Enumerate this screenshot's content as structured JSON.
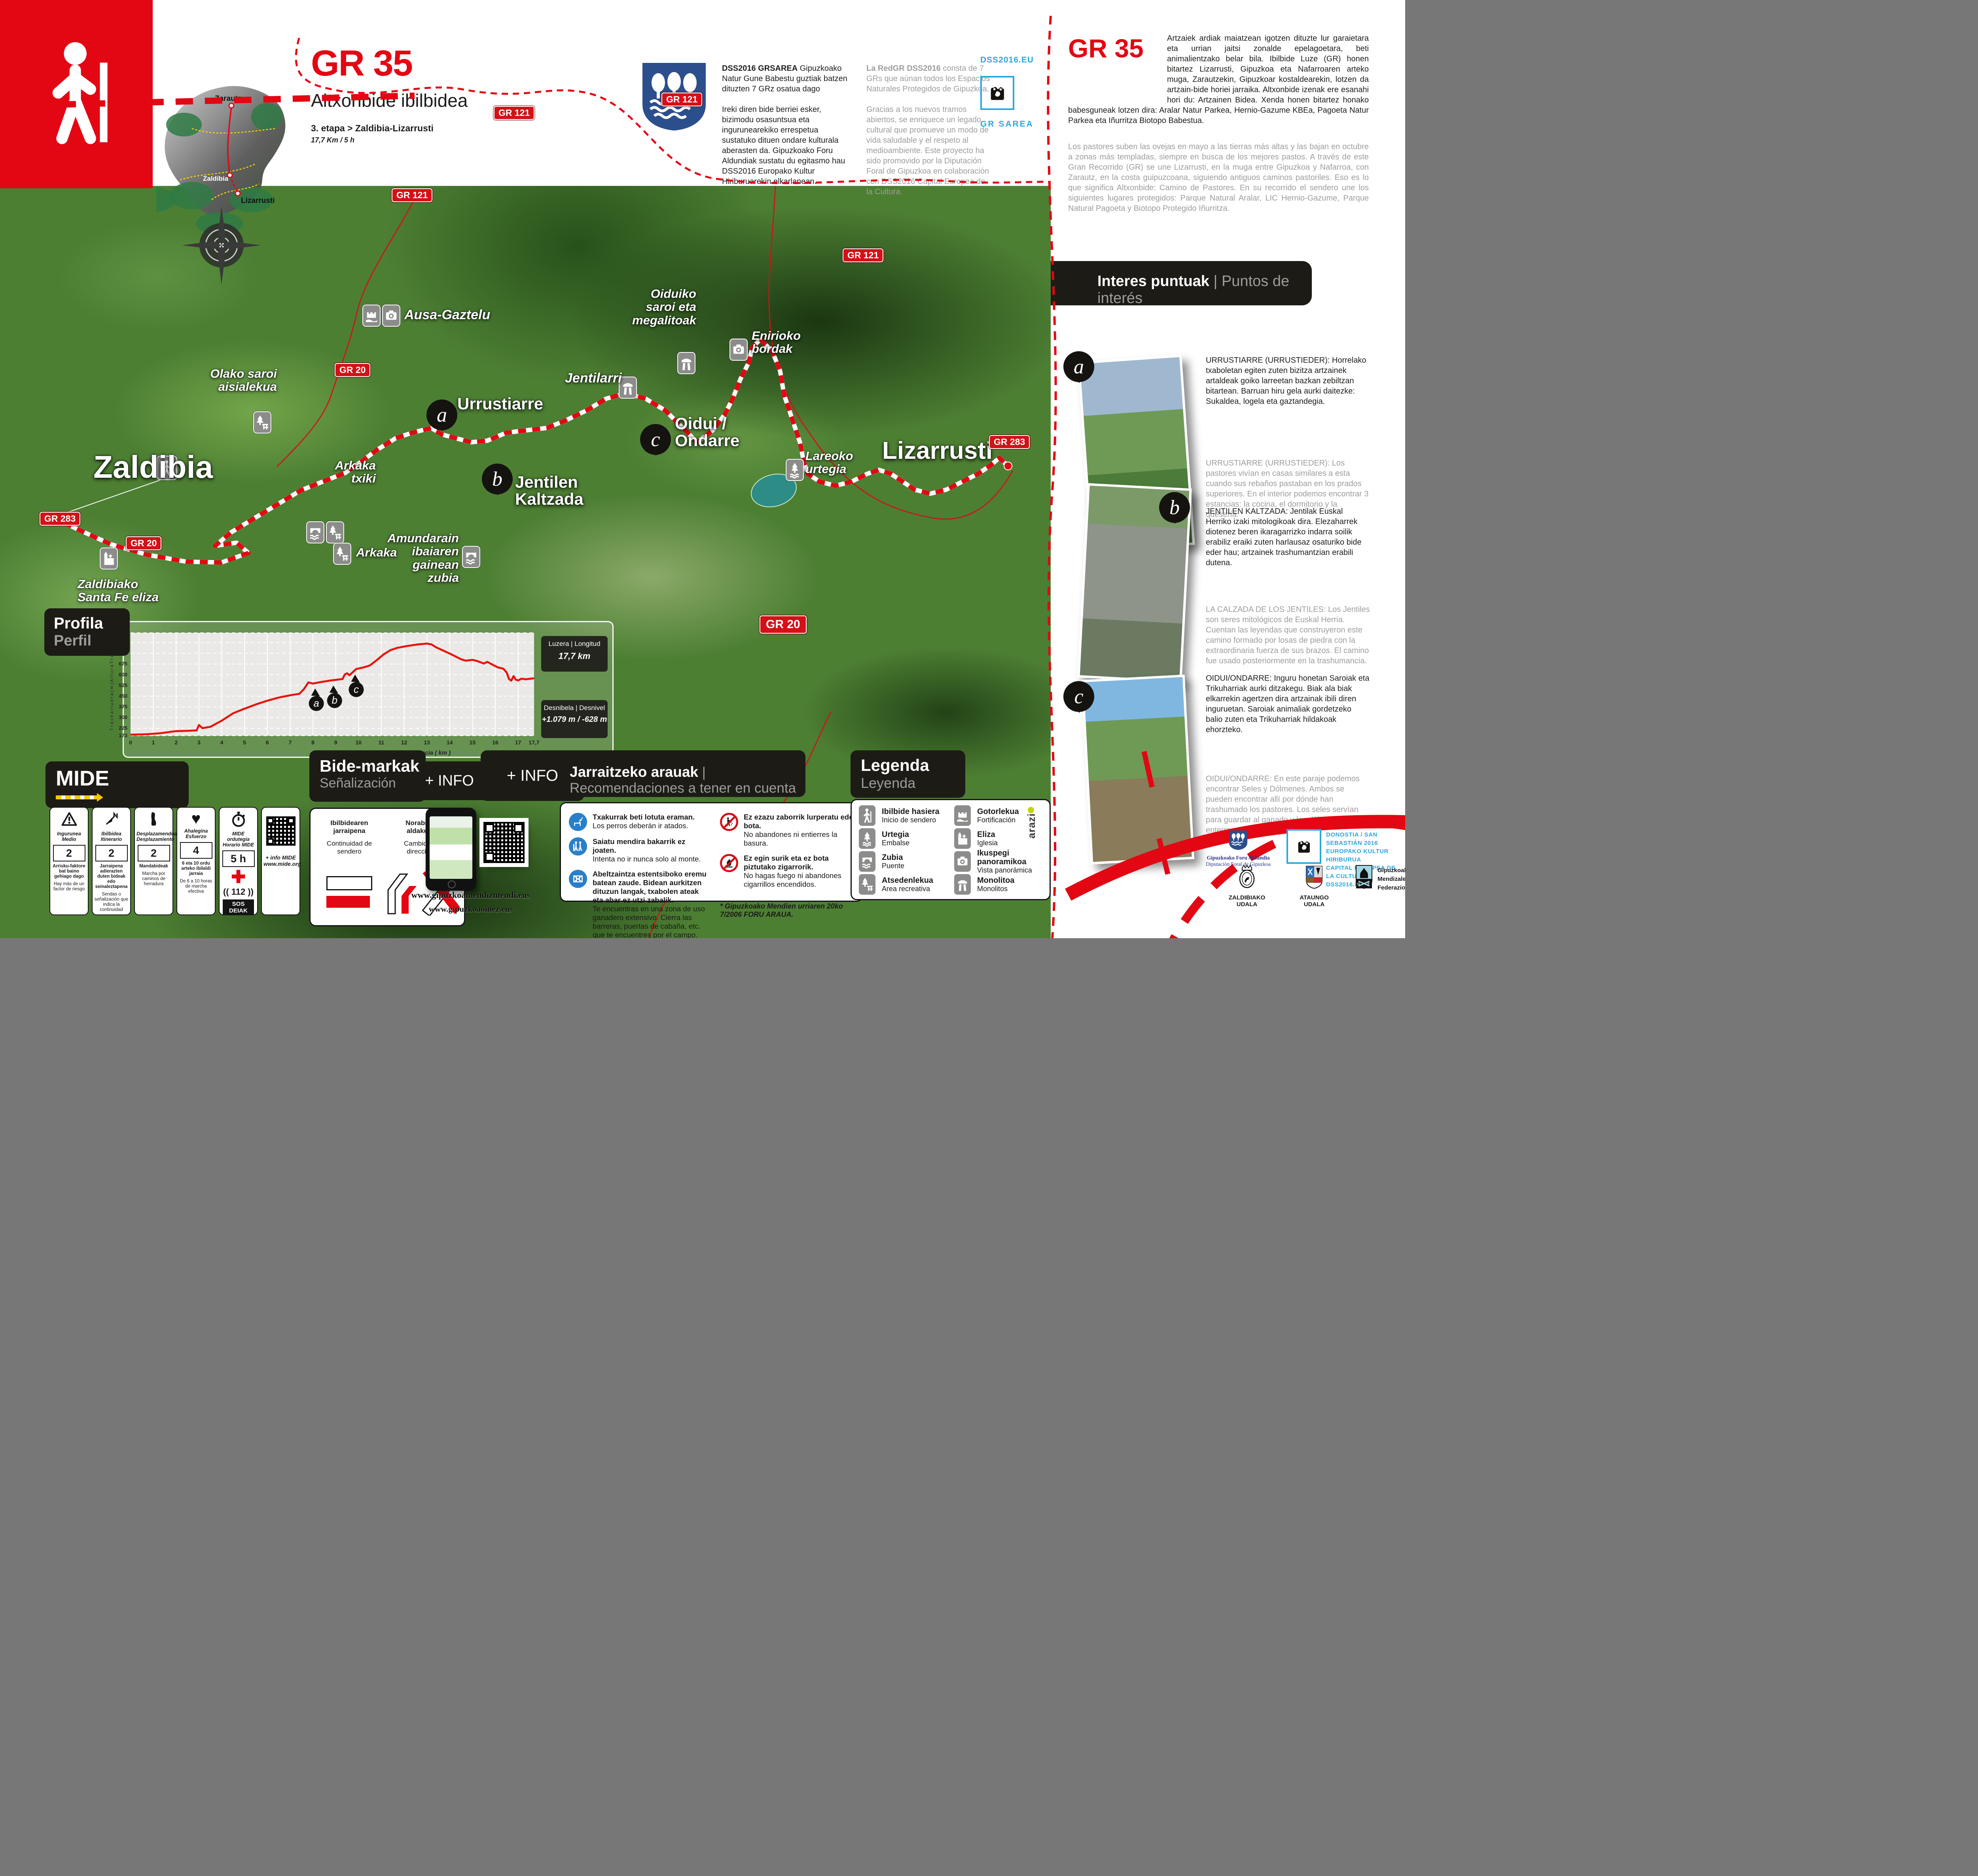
{
  "poster": {
    "title": {
      "code": "GR 35",
      "name": "Altxonbide ibilbidea",
      "stage": "3. etapa > Zaldibia-Lizarrusti",
      "distance": "17,7 Km / 5 h"
    },
    "inset": {
      "top": "Zarautz",
      "mid": "Zaldibia",
      "bottom": "Lizarrusti"
    },
    "intro_left": {
      "lead": "DSS2016 GRSAREA",
      "p1": " Gipuzkoako Natur Gune Babestu guztiak batzen dituzten 7 GRz osatua dago",
      "p2": "Ireki diren bide berriei esker,  bizimodu osasuntsua eta ingurunearekiko errespetua sustatuko dituen ondare kulturala aberasten da. Gipuzkoako Foru Aldundiak sustatu du egitasmo hau DSS2016 Europako Kultur Hiriburuarekin elkarlanean."
    },
    "intro_right": {
      "lead": "La RedGR DSS2016",
      "p1": " consta de 7 GRs que aúnan todos los Espacios Naturales Protegidos de Gipuzkoa.",
      "p2": "Gracias a los nuevos tramos abiertos, se enriquece un legado cultural que promueve un modo de vida saludable y el respeto al medioambiente. Este proyecto ha sido promovido por la Diputación Foral de Gipuzkoa en colaboración con DSS2016 Capital Europea de la Cultura."
    },
    "dss": {
      "site": "DSS2016.EU",
      "network": "GR SAREA"
    }
  },
  "panel": {
    "code": "GR 35",
    "intro_eus": "Artzaiek ardiak maiatzean igotzen dituzte lur garaietara eta urrian jaitsi zonalde epelagoetara, beti animalientzako belar bila. Ibilbide Luze (GR) honen bitartez Lizarrusti, Gipuzkoa eta Nafarroaren arteko muga, Zarautzekin, Gipuzkoar kostaldearekin, lotzen da artzain-bide horiei jarraika. Altxonbide izenak ere esanahi hori du: Artzainen Bidea. Xenda honen bitartez honako babesguneak lotzen dira: Aralar Natur Parkea, Hernio-Gazume KBEa, Pagoeta Natur Parkea eta Iñurritza Biotopo Babestua.",
    "intro_es": "Los pastores suben las ovejas en mayo a las tierras más altas y las bajan en octubre a zonas más templadas, siempre en busca de los mejores pastos. A través de este Gran Recorrido (GR) se une Lizarrusti, en la muga entre Gipuzkoa y Nafarroa, con Zarautz, en la costa guipuzcoana, siguiendo antiguos caminos pastoriles. Eso es lo que significa Altxonbide: Camino de Pastores. En su recorrido el sendero une los siguientes lugares protegidos: Parque Natural Aralar, LIC Hernio-Gazume, Parque Natural Pagoeta y Biotopo Protegido Iñurritza.",
    "poi_header": {
      "eus": "Interes puntuak",
      "sep": " | ",
      "es": "Puntos de interés"
    },
    "pois": [
      {
        "letter": "a",
        "eus": "URRUSTIARRE (URRUSTIEDER): Horrelako txaboletan egiten zuten bizitza artzainek artaldeak goiko larreetan bazkan zebiltzan bitartean. Barruan hiru gela aurki daitezke: Sukaldea, logela eta gaztandegia.",
        "es": "URRUSTIARRE (URRUSTIEDER): Los pastores vivían en casas similares a esta cuando sus rebaños pastaban en los prados superiores. En el interior podemos encontrar 3 estancias: la cocina, el dormitorio y la quesería."
      },
      {
        "letter": "b",
        "eus": "JENTILEN KALTZADA: Jentilak Euskal Herriko izaki mitologikoak dira. Elezaharrek diotenez beren ikaragarrizko indarra soilik erabiliz eraiki zuten harlausaz osaturiko bide eder hau; artzainek trashumantzian erabili dutena.",
        "es": "LA CALZADA DE LOS JENTILES: Los Jentiles son seres mitológicos de Euskal Herria. Cuentan las leyendas que construyeron este camino formado por losas de piedra con la extraordinaria fuerza de sus brazos. El camino fue usado posteriormente en la trashumancia."
      },
      {
        "letter": "c",
        "eus": "OIDUI/ONDARRE: Inguru honetan Saroiak eta Trikuharriak aurki ditzakegu. Biak ala biak elkarrekin agertzen dira artzainak ibili diren inguruetan. Saroiak animaliak gordetzeko balio zuten eta Trikuharriak hildakoak ehorzteko.",
        "es": "OIDUI/ONDARRE: En este paraje podemos encontrar Seles y Dólmenes. Ambos se pueden encontrar allí por dónde han trashumado los pastores. Los seles servían para guardar al ganado y los dólmenes para enterrar a los muertos."
      }
    ]
  },
  "map": {
    "badges": [
      {
        "label": "GR 121"
      },
      {
        "label": "GR 121"
      },
      {
        "label": "GR 121"
      },
      {
        "label": "GR 121"
      },
      {
        "label": "GR 20"
      },
      {
        "label": "GR 20"
      },
      {
        "label": "GR 20"
      },
      {
        "label": "GR 283"
      },
      {
        "label": "GR 283"
      }
    ],
    "places": {
      "zaldibia": "Zaldibia",
      "santafe": "Zaldibiako\nSanta Fe eliza",
      "amundarain": "Amundarain\nibaiaren gainean\nzubia",
      "olako": "Olako saroi\naisialekua",
      "arkakatxiki": "Arkaka\ntxiki",
      "arkaka": "Arkaka",
      "ausa": "Ausa-Gaztelu",
      "urrustiarre": "Urrustiarre",
      "jentilen": "Jentilen\nKaltzada",
      "jentilarri": "Jentilarri",
      "oiduiko": "Oiduiko\nsaroi eta\nmegalitoak",
      "enirioko": "Enirioko\nbordak",
      "oidui": "Oidui /\nOndarre",
      "lareoko": "Lareoko\nurtegia",
      "lizarrusti": "Lizarrusti"
    },
    "markers": [
      {
        "letter": "a"
      },
      {
        "letter": "b"
      },
      {
        "letter": "c"
      }
    ],
    "route": [
      [
        130,
        1306
      ],
      [
        200,
        1340
      ],
      [
        280,
        1376
      ],
      [
        370,
        1402
      ],
      [
        470,
        1420
      ],
      [
        560,
        1422
      ],
      [
        628,
        1398
      ],
      [
        598,
        1372
      ],
      [
        544,
        1380
      ],
      [
        584,
        1346
      ],
      [
        640,
        1312
      ],
      [
        700,
        1276
      ],
      [
        760,
        1240
      ],
      [
        820,
        1216
      ],
      [
        872,
        1196
      ],
      [
        912,
        1168
      ],
      [
        952,
        1138
      ],
      [
        1000,
        1108
      ],
      [
        1042,
        1094
      ],
      [
        1090,
        1082
      ],
      [
        1116,
        1098
      ],
      [
        1152,
        1108
      ],
      [
        1192,
        1118
      ],
      [
        1232,
        1114
      ],
      [
        1280,
        1094
      ],
      [
        1330,
        1088
      ],
      [
        1382,
        1082
      ],
      [
        1432,
        1062
      ],
      [
        1482,
        1038
      ],
      [
        1532,
        1008
      ],
      [
        1582,
        994
      ],
      [
        1632,
        1008
      ],
      [
        1682,
        1038
      ],
      [
        1722,
        1078
      ],
      [
        1762,
        1118
      ],
      [
        1802,
        1088
      ],
      [
        1832,
        1048
      ],
      [
        1852,
        1008
      ],
      [
        1872,
        958
      ],
      [
        1892,
        918
      ],
      [
        1902,
        878
      ],
      [
        1922,
        858
      ],
      [
        1952,
        888
      ],
      [
        1972,
        938
      ],
      [
        1982,
        998
      ],
      [
        2002,
        1058
      ],
      [
        2022,
        1118
      ],
      [
        2032,
        1168
      ],
      [
        2042,
        1198
      ],
      [
        2072,
        1218
      ],
      [
        2112,
        1228
      ],
      [
        2152,
        1218
      ],
      [
        2192,
        1198
      ],
      [
        2222,
        1188
      ],
      [
        2252,
        1198
      ],
      [
        2282,
        1218
      ],
      [
        2312,
        1238
      ],
      [
        2352,
        1248
      ],
      [
        2392,
        1238
      ],
      [
        2432,
        1218
      ],
      [
        2472,
        1198
      ],
      [
        2502,
        1178
      ],
      [
        2526,
        1158
      ],
      [
        2548,
        1178
      ]
    ]
  },
  "chart_data": {
    "type": "line",
    "title_eus": "Profila",
    "title_es": "Perfil",
    "xlabel": "Distantzia ( km )   |   Distancia ( km )",
    "ylabel": "T r a c k   a l t u e r a  ( m )     A l t u r a   T r a c k  ( m )",
    "xlim": [
      0,
      17.7
    ],
    "ylim": [
      173,
      893
    ],
    "yticks": [
      893,
      825,
      750,
      675,
      600,
      525,
      450,
      375,
      300,
      225,
      173
    ],
    "xticks": [
      0,
      1,
      2,
      3,
      4,
      5,
      6,
      7,
      8,
      9,
      10,
      11,
      12,
      13,
      14,
      15,
      16,
      17,
      17.7
    ],
    "length_label": "Luzera | Longitud",
    "length_value": "17,7 km",
    "elevation_label": "Desnibela | Desnivel",
    "elevation_value": "+1.079 m / -628 m",
    "markers": [
      {
        "letter": "a",
        "km": 8.15
      },
      {
        "letter": "b",
        "km": 8.95
      },
      {
        "letter": "c",
        "km": 9.9
      }
    ],
    "points": [
      [
        0,
        180
      ],
      [
        0.7,
        183
      ],
      [
        1.3,
        190
      ],
      [
        2,
        205
      ],
      [
        2.5,
        207
      ],
      [
        2.9,
        210
      ],
      [
        3.0,
        248
      ],
      [
        3.15,
        226
      ],
      [
        3.5,
        235
      ],
      [
        4,
        278
      ],
      [
        4.5,
        330
      ],
      [
        5,
        362
      ],
      [
        5.5,
        392
      ],
      [
        6,
        418
      ],
      [
        6.5,
        440
      ],
      [
        7,
        456
      ],
      [
        7.4,
        466
      ],
      [
        7.6,
        498
      ],
      [
        7.8,
        546
      ],
      [
        8.0,
        538
      ],
      [
        8.4,
        550
      ],
      [
        8.8,
        560
      ],
      [
        9.1,
        566
      ],
      [
        9.3,
        570
      ],
      [
        9.4,
        602
      ],
      [
        9.5,
        610
      ],
      [
        9.6,
        596
      ],
      [
        9.9,
        640
      ],
      [
        10.2,
        650
      ],
      [
        10.5,
        665
      ],
      [
        10.8,
        702
      ],
      [
        11.1,
        742
      ],
      [
        11.4,
        772
      ],
      [
        11.7,
        788
      ],
      [
        12.1,
        800
      ],
      [
        12.6,
        812
      ],
      [
        13.0,
        818
      ],
      [
        13.2,
        812
      ],
      [
        13.4,
        792
      ],
      [
        13.7,
        770
      ],
      [
        14.0,
        748
      ],
      [
        14.2,
        732
      ],
      [
        14.5,
        708
      ],
      [
        14.7,
        698
      ],
      [
        15.0,
        704
      ],
      [
        15.2,
        696
      ],
      [
        15.5,
        678
      ],
      [
        15.65,
        690
      ],
      [
        15.9,
        668
      ],
      [
        16.1,
        652
      ],
      [
        16.35,
        642
      ],
      [
        16.5,
        615
      ],
      [
        16.6,
        570
      ],
      [
        16.7,
        558
      ],
      [
        16.8,
        590
      ],
      [
        16.9,
        565
      ],
      [
        17.0,
        560
      ],
      [
        17.15,
        572
      ],
      [
        17.35,
        568
      ],
      [
        17.55,
        572
      ],
      [
        17.7,
        575
      ]
    ]
  },
  "mide": {
    "title": "MIDE",
    "info_label": "+ INFO",
    "cards": [
      {
        "t_eus": "Ingurunea",
        "t_es": "Medio",
        "value": "2",
        "d_eus": "Arrisku-faktore bat baino gehiago dago",
        "d_es": "Hay más de un factor de riesgo"
      },
      {
        "t_eus": "Ibilbidea",
        "t_es": "Itinerario",
        "value": "2",
        "d_eus": "Jarraipena adierazten duten bideak edo seinaleztapena",
        "d_es": "Sendas o señalización que indica la continuidad"
      },
      {
        "t_eus": "Desplazamendua",
        "t_es": "Desplazamiento",
        "value": "2",
        "d_eus": "Mandabideak",
        "d_es": "Marcha por caminos de herradura"
      },
      {
        "t_eus": "Ahalegina",
        "t_es": "Esfuerzo",
        "value": "4",
        "d_eus": "6 eta 10 ordu arteko ibilaldi jarraia",
        "d_es": "De 6 a 10 horas de marcha efectiva"
      },
      {
        "t_eus": "MIDE ordutegia",
        "t_es": "Horario MIDE",
        "value": "5 h",
        "sos": "(( 112 ))",
        "sos_label": "SOS DEIAK"
      },
      {
        "info": "+ info MIDE",
        "url": "www.mide.org"
      }
    ]
  },
  "signage": {
    "title_eus": "Bide-markak",
    "title_es": "Señalización",
    "info_label": "+ INFO",
    "items": [
      {
        "eus": "Ibilbidearen\njarraipena",
        "es": "Continuidad de\nsendero"
      },
      {
        "eus": "Norabide\naldaketa",
        "es": "Cambio de\ndirección"
      }
    ],
    "urls": [
      "www.gipuzkoamendizmendi.eus",
      "www.gipuzkoaoinez.eus"
    ]
  },
  "rules": {
    "title_eus": "Jarraitzeko arauak",
    "sep": " | ",
    "title_es": "Recomendaciones a tener en cuenta",
    "items": [
      {
        "eus": "Txakurrak beti lotuta eraman.",
        "es": "Los perros deberán ir atados."
      },
      {
        "eus": "Saiatu mendira bakarrik ez joaten.",
        "es": "Intenta no ir nunca solo al monte."
      },
      {
        "eus": "Abeltzaintza estentsiboko eremu batean zaude. Bidean aurkitzen dituzun langak, txabolen ateak eta abar ez utzi zabalik.",
        "es": "Te encuentras en una zona de uso ganadero  extensivo. Cierra las barreras, puertas de cabaña, etc. que te encuentres por el campo."
      },
      {
        "eus": "Ez ezazu zaborrik lurperatu edo bota.",
        "es": "No abandones ni entierres la basura."
      },
      {
        "eus": "Ez egin surik eta ez bota piztutako zigarrorik.",
        "es": "No hagas fuego ni abandones cigarrillos encendidos."
      }
    ],
    "footnote": "* Gipuzkoako Mendien urriaren 20ko 7/2006 FORU ARAUA."
  },
  "legend": {
    "title_eus": "Legenda",
    "title_es": "Leyenda",
    "items": [
      {
        "eus": "Ibilbide hasiera",
        "es": "Inicio de sendero"
      },
      {
        "eus": "Urtegia",
        "es": "Embalse"
      },
      {
        "eus": "Zubia",
        "es": "Puente"
      },
      {
        "eus": "Atsedenlekua",
        "es": "Area recreativa"
      },
      {
        "eus": "Gotorlekua",
        "es": "Fortificación"
      },
      {
        "eus": "Eliza",
        "es": "Iglesia"
      },
      {
        "eus": "Ikuspegi panoramikoa",
        "es": "Vista panorámica"
      },
      {
        "eus": "Monolitoa",
        "es": "Monolitos"
      }
    ]
  },
  "footer": {
    "arazi": "arazi",
    "foru": {
      "l1": "Gipuzkoako Foru Aldundia",
      "l2": "Diputación Foral de Gipuzkoa"
    },
    "dss": {
      "l1": "DONOSTIA / SAN SEBASTIÁN 2016",
      "l2": "EUROPAKO KULTUR HIRIBURUA",
      "l3": "CAPITAL EUROPEA DE LA CULTURA",
      "l4": "DSS2016.EU"
    },
    "zaldibia": "ZALDIBIAKO UDALA",
    "ataun": "ATAUNGO UDALA",
    "gmf": {
      "l1": "Gipuzkoako",
      "l2": "Mendizale",
      "l3": "Federazioa"
    }
  }
}
